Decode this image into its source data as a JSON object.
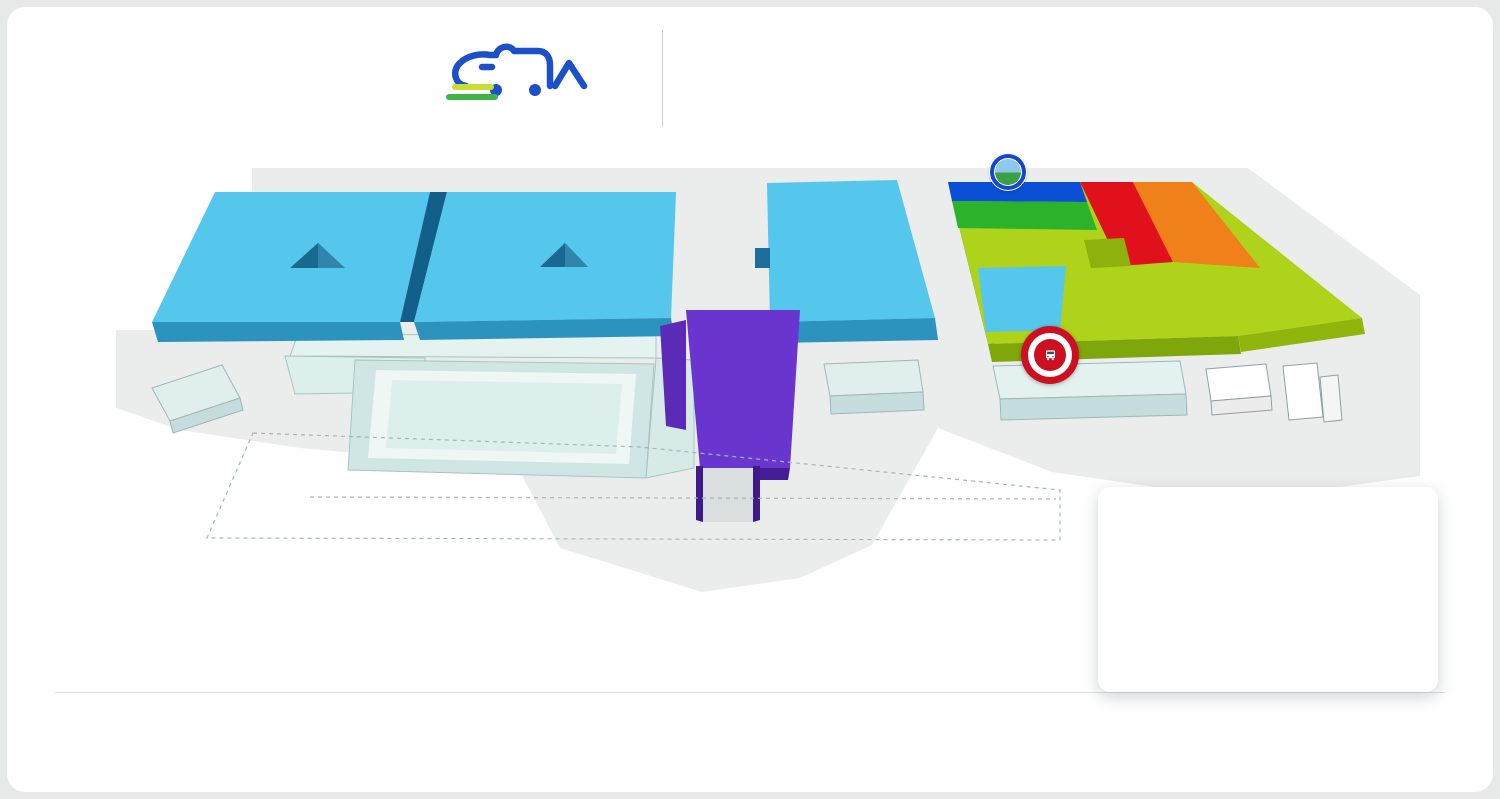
{
  "header": {
    "logo_title": "IL SALONE DEL CAMPER",
    "logo_subtitle": "CARAVAN ACCESSORI PERCORSI E METE",
    "title_line1": "PLANIMETRIA GENERALE",
    "title_line2": "GENERAL PLAN"
  },
  "colors": {
    "brand_blue": "#1356cb",
    "accent_blue_icon": "#1240d4",
    "dark_icon": "#3e4b52",
    "hall_cyan": "#55c6ec",
    "hall_purple": "#6a35cf",
    "hall2_blue": "#0b4fd6",
    "hall2_green": "#2cb32c",
    "hall2_lime": "#aed31a",
    "hall2_red": "#e0111a",
    "hall2_orange": "#f08019",
    "ev_green": "#62cf2e",
    "parking_orange": "#f08019",
    "street_food_red": "#cc1022"
  },
  "icon_letters": {
    "parking": "P",
    "tabacchi": "T",
    "reception": "R",
    "bancomat": "3",
    "info": "i",
    "press": "PRESS",
    "meet": "MEET",
    "pt": "PT",
    "pb": "PB"
  },
  "map": {
    "halls": [
      {
        "num": "6",
        "x": 300,
        "y": 213,
        "size": 62
      },
      {
        "num": "5",
        "x": 525,
        "y": 213,
        "size": 62
      },
      {
        "num": "3",
        "x": 837,
        "y": 175,
        "size": 66
      },
      {
        "num": "2",
        "x": 1122,
        "y": 172,
        "size": 66
      },
      {
        "num": "4",
        "x": 742,
        "y": 341,
        "size": 58
      },
      {
        "num": "7",
        "x": 343,
        "y": 368,
        "size": 56
      }
    ],
    "entrances": [
      {
        "key": "west",
        "it": "INGRESSO OVEST",
        "en": "WEST ENTRANCE",
        "x": 168,
        "y": 418
      },
      {
        "key": "south",
        "it": "INGRESSO SUD",
        "en": "SOUTH ENTRANCE",
        "x": 723,
        "y": 536
      },
      {
        "key": "east",
        "it": "INGRESSO EST",
        "en": "EAST ENTRANCE",
        "x": 1247,
        "y": 434
      }
    ],
    "parkings": [
      {
        "label": "BLUE",
        "style": "blue",
        "x": 134,
        "y": 255
      },
      {
        "label": "ORANGE",
        "style": "orange",
        "x": 136,
        "y": 506
      },
      {
        "label": "WHITE",
        "style": "white",
        "x": 515,
        "y": 554
      }
    ],
    "buildings": [
      {
        "key": "warehouses",
        "it": "MAGAZZINI",
        "en": "WAREHOUSES",
        "x": 872,
        "y": 379
      },
      {
        "key": "offices",
        "it": "UFFICI",
        "en": "OFFICES",
        "x": 1090,
        "y": 380
      }
    ],
    "floor_notes": [
      {
        "line1": "1° PIANO",
        "line2": "1st FLOOR",
        "x": 502,
        "y": 255
      },
      {
        "line1": "1° PIANO",
        "line2": "1st FLOOR",
        "x": 800,
        "y": 427
      }
    ],
    "street_food_badge": {
      "top": "STREET FOOD",
      "middle": "PARMA",
      "bottom": "QUALITY"
    },
    "icons": [
      {
        "t": "bus",
        "x": 158,
        "y": 247
      },
      {
        "t": "wc",
        "x": 257,
        "y": 215
      },
      {
        "t": "wc",
        "x": 425,
        "y": 215
      },
      {
        "t": "cup",
        "x": 415,
        "y": 242
      },
      {
        "t": "plant",
        "v": "blue",
        "x": 272,
        "y": 266
      },
      {
        "t": "cup",
        "x": 198,
        "y": 288
      },
      {
        "t": "wc",
        "x": 181,
        "y": 307
      },
      {
        "t": "bancomat",
        "x": 275,
        "y": 307
      },
      {
        "t": "info",
        "x": 302,
        "y": 307
      },
      {
        "t": "wc",
        "x": 387,
        "y": 307
      },
      {
        "t": "cup",
        "x": 472,
        "y": 242
      },
      {
        "t": "wc",
        "x": 463,
        "y": 268
      },
      {
        "t": "fork",
        "x": 489,
        "y": 268
      },
      {
        "t": "info",
        "x": 577,
        "y": 282
      },
      {
        "t": "bank",
        "x": 631,
        "y": 254
      },
      {
        "t": "cup",
        "x": 657,
        "y": 244
      },
      {
        "t": "wc",
        "x": 653,
        "y": 268
      },
      {
        "t": "fork",
        "x": 716,
        "y": 220
      },
      {
        "t": "rugby",
        "v": "blue",
        "x": 718,
        "y": 247
      },
      {
        "t": "chef",
        "v": "blue",
        "x": 706,
        "y": 284
      },
      {
        "t": "picnic",
        "v": "blue",
        "x": 750,
        "y": 292
      },
      {
        "t": "wc",
        "x": 781,
        "y": 193
      },
      {
        "t": "cup",
        "x": 885,
        "y": 193
      },
      {
        "t": "cup",
        "x": 771,
        "y": 236
      },
      {
        "t": "info",
        "x": 783,
        "y": 259
      },
      {
        "t": "bank",
        "x": 800,
        "y": 311
      },
      {
        "t": "tabacchi",
        "x": 825,
        "y": 311
      },
      {
        "t": "wc",
        "x": 849,
        "y": 311
      },
      {
        "t": "fork",
        "x": 840,
        "y": 355
      },
      {
        "t": "dog",
        "v": "blue",
        "x": 890,
        "y": 357
      },
      {
        "t": "wc",
        "x": 967,
        "y": 196
      },
      {
        "t": "cup",
        "x": 1048,
        "y": 203
      },
      {
        "t": "children",
        "v": "blue",
        "x": 1085,
        "y": 210
      },
      {
        "t": "book",
        "v": "blue",
        "x": 1071,
        "y": 230
      },
      {
        "t": "bear",
        "v": "blue",
        "x": 1097,
        "y": 230
      },
      {
        "t": "wc",
        "x": 1167,
        "y": 196
      },
      {
        "t": "sports",
        "v": "blue",
        "x": 952,
        "y": 312
      },
      {
        "t": "bank",
        "x": 1031,
        "y": 310
      },
      {
        "t": "wc",
        "x": 1128,
        "y": 312
      },
      {
        "t": "info",
        "x": 1245,
        "y": 312
      },
      {
        "t": "cup",
        "x": 1272,
        "y": 317
      },
      {
        "t": "fork",
        "x": 1293,
        "y": 315
      },
      {
        "t": "pt",
        "x": 703,
        "y": 333
      },
      {
        "t": "camper",
        "v": "blue",
        "x": 731,
        "y": 383
      },
      {
        "t": "mountain",
        "v": "blue",
        "x": 756,
        "y": 381
      },
      {
        "t": "cup",
        "x": 780,
        "y": 381
      },
      {
        "t": "fire",
        "x": 805,
        "y": 385
      },
      {
        "t": "bancomat",
        "x": 710,
        "y": 395
      },
      {
        "t": "camera",
        "v": "blue",
        "x": 733,
        "y": 406
      },
      {
        "t": "info",
        "x": 757,
        "y": 408
      },
      {
        "t": "press",
        "x": 781,
        "y": 407
      },
      {
        "t": "cross",
        "x": 806,
        "y": 407
      },
      {
        "t": "wc",
        "x": 736,
        "y": 431
      },
      {
        "t": "pb",
        "x": 760,
        "y": 432
      },
      {
        "t": "fork",
        "x": 783,
        "y": 433
      },
      {
        "t": "reception",
        "x": 710,
        "y": 453
      },
      {
        "t": "nursery",
        "x": 760,
        "y": 456
      },
      {
        "t": "wc",
        "x": 784,
        "y": 458
      },
      {
        "t": "fork",
        "x": 310,
        "y": 372
      },
      {
        "t": "meet",
        "x": 520,
        "y": 347
      },
      {
        "t": "cross",
        "x": 233,
        "y": 382
      },
      {
        "t": "charge",
        "v": "green",
        "x": 123,
        "y": 388
      },
      {
        "t": "bus",
        "x": 452,
        "y": 518
      },
      {
        "t": "plug",
        "x": 478,
        "y": 518
      },
      {
        "t": "bus",
        "x": 797,
        "y": 563
      },
      {
        "t": "taxi",
        "x": 827,
        "y": 563
      },
      {
        "t": "charge",
        "v": "green",
        "x": 1180,
        "y": 447
      }
    ]
  },
  "entertainment": {
    "title_it": "ATTIVITÀ DI INTRATTENIMENTO",
    "title_en": "Entertainment  Activities",
    "items_left": [
      {
        "icon": "dog",
        "it": "Area Amici 4 Zampe",
        "en": "Pets Area"
      },
      {
        "icon": "picnic",
        "it": "Pic-Nic nel Bosco Temporaneo",
        "en": "Temporary Wood Pic-Nic"
      },
      {
        "icon": "camper",
        "it": "Camper Facile",
        "en": "Easy Camper"
      },
      {
        "icon": "mountain",
        "it": "Club Alpino Italiano",
        "en": "Italian Alpine Club"
      },
      {
        "icon": "chef",
        "it": "Cucinare in Camper",
        "en": "Camper Cooking"
      },
      {
        "icon": "bear",
        "it": "Le Favole dell'Orso Ludo",
        "en": "Ludo Bear Tales"
      }
    ],
    "items_right": [
      {
        "icon": "children",
        "it": "Kinderheim: la Tenda nel Bosco",
        "en": "Children's Area"
      },
      {
        "icon": "sports",
        "it": "Il Villaggio degli Sport",
        "en": "Sports Village"
      },
      {
        "icon": "plant",
        "it": "L'Oasi del Salone",
        "en": "Salone's Oasis"
      },
      {
        "icon": "rugby",
        "it": "Mete in Camper",
        "en": "Camper Goals"
      },
      {
        "icon": "camera",
        "it": "Camper Social Club",
        "en": "Camper Social Club"
      },
      {
        "icon": "book",
        "it": "Viaggi, Incontri e Racconti",
        "en": "Travels, Encounters and Stories"
      }
    ]
  },
  "padiglione_label": "PADIGLIONE",
  "categories": [
    {
      "hall": "HALL 2",
      "name": [
        "ACCESSORI"
      ],
      "sub": [
        "Accessories"
      ],
      "color": "#8cd41e",
      "icon": "binoculars",
      "x": 63
    },
    {
      "hall": "HALL 2-3-5-6",
      "name": [
        "CAMPER E",
        "CARAVAN"
      ],
      "sub": [
        "Camper and Caravan"
      ],
      "color": "#3bc8f0",
      "icon": "busfront",
      "x": 200
    },
    {
      "hall": "HALL 4",
      "name": [
        "ENTI E",
        "ASSOCIAZIONI"
      ],
      "sub": [
        "Institutions and Associations"
      ],
      "color": "#7a3cf2",
      "icon": "group",
      "x": 345
    },
    {
      "hall": "HALL 2",
      "name": [
        "PERCORSI",
        "E METE"
      ],
      "sub": [
        "Routes and Destinations"
      ],
      "extra": "La Strada dei Sapori",
      "color": "#23ba23",
      "icon": "globe",
      "x": 503,
      "badge": true
    },
    {
      "hall": "HALL 2",
      "name": [
        "PRODOTTI E ATTREZZATURE PER",
        "CAMPEGGI E AREE SOSTA CAMPER"
      ],
      "sub": [
        "Products and Equipment for",
        "Campings and Camper Parking Areas"
      ],
      "color": "#e00b1e",
      "icon": "tableumb",
      "x": 650,
      "small": true
    },
    {
      "hall": "HALL 2",
      "name": [
        "AREA",
        "SHOPPING"
      ],
      "sub": [
        "Shopping Area"
      ],
      "color": "#f5861f",
      "icon": "bag",
      "x": 878
    }
  ],
  "facilities": [
    {
      "icon": "plug",
      "it": "Allaccio Elettrico Camper",
      "en": "Camper Electric Connection",
      "col": 0,
      "row": 0
    },
    {
      "icon": "bank",
      "it": "Banca",
      "en": "Bank",
      "col": 0,
      "row": 1
    },
    {
      "icon": "wc",
      "it": "Bagni",
      "en": "Toilettes",
      "col": 1,
      "row": 0
    },
    {
      "icon": "bancomat",
      "it": "Bancomat",
      "en": "Cash Withdrawl",
      "col": 1,
      "row": 1
    },
    {
      "icon": "cup",
      "it": "Caffetteria",
      "en": "Bar",
      "col": 2,
      "row": 0
    },
    {
      "icon": "bus",
      "it": "Fermata Bus",
      "en": "Bus Stop",
      "col": 2,
      "row": 1
    },
    {
      "icon": "parking",
      "it": "Parcheggio",
      "en": "Parking",
      "col": 3,
      "row": 0
    },
    {
      "icon": "pt",
      "it": "Prodotto Tipico",
      "en": "Typical Product",
      "col": 3,
      "row": 1
    },
    {
      "icon": "cross",
      "it": "Pronto Soccorso",
      "en": "First Aid",
      "col": 4,
      "row": 0
    },
    {
      "icon": "pb",
      "it": "Prosciutto Bar",
      "en": "Ham Bar",
      "col": 4,
      "row": 1
    },
    {
      "icon": "info",
      "it": "Punto Informazioni",
      "en": "Info Point",
      "col": 5,
      "row": 0
    },
    {
      "icon": "reception",
      "it": "Reception",
      "en": "",
      "col": 5,
      "row": 1
    },
    {
      "icon": "fork",
      "it": "Ristorante",
      "en": "Restaurant",
      "col": 6,
      "row": 0
    },
    {
      "icon": "meet",
      "it": "Sala Meeting",
      "en": "Meeting Area",
      "col": 6,
      "row": 1
    },
    {
      "icon": "press",
      "it": "Sala Stampa",
      "en": "Press Area",
      "col": 7,
      "row": 0
    },
    {
      "icon": "service",
      "it": "Servizio Camper",
      "en": "Camper Service",
      "col": 7,
      "row": 1
    },
    {
      "icon": "agora",
      "it": "Spazio Agorà",
      "en": "",
      "col": 8,
      "row": 0
    },
    {
      "icon": "nursery",
      "it": "Nursery",
      "en": "",
      "col": 8,
      "row": 1
    },
    {
      "icon": "tabacchi",
      "it": "Tabacchi",
      "en": "Tobacconist",
      "col": 9,
      "row": 0
    },
    {
      "icon": "taxi",
      "it": "Taxi",
      "en": "",
      "col": 9,
      "row": 1
    },
    {
      "icon": "fire",
      "it": "Vigili Del Fuoco",
      "en": "Fire Fighters",
      "col": 10,
      "row": 0
    },
    {
      "icon": "charge",
      "v": "green",
      "it": "Stazione Ricarica Veicoli Elettrici",
      "en": "Electric Car Charge Station",
      "col": 10,
      "row": 1
    }
  ],
  "facility_cols_x": [
    57,
    214,
    324,
    424,
    539,
    657,
    784,
    884,
    1004,
    1109,
    1204
  ],
  "facility_rows_y": [
    697,
    729
  ]
}
